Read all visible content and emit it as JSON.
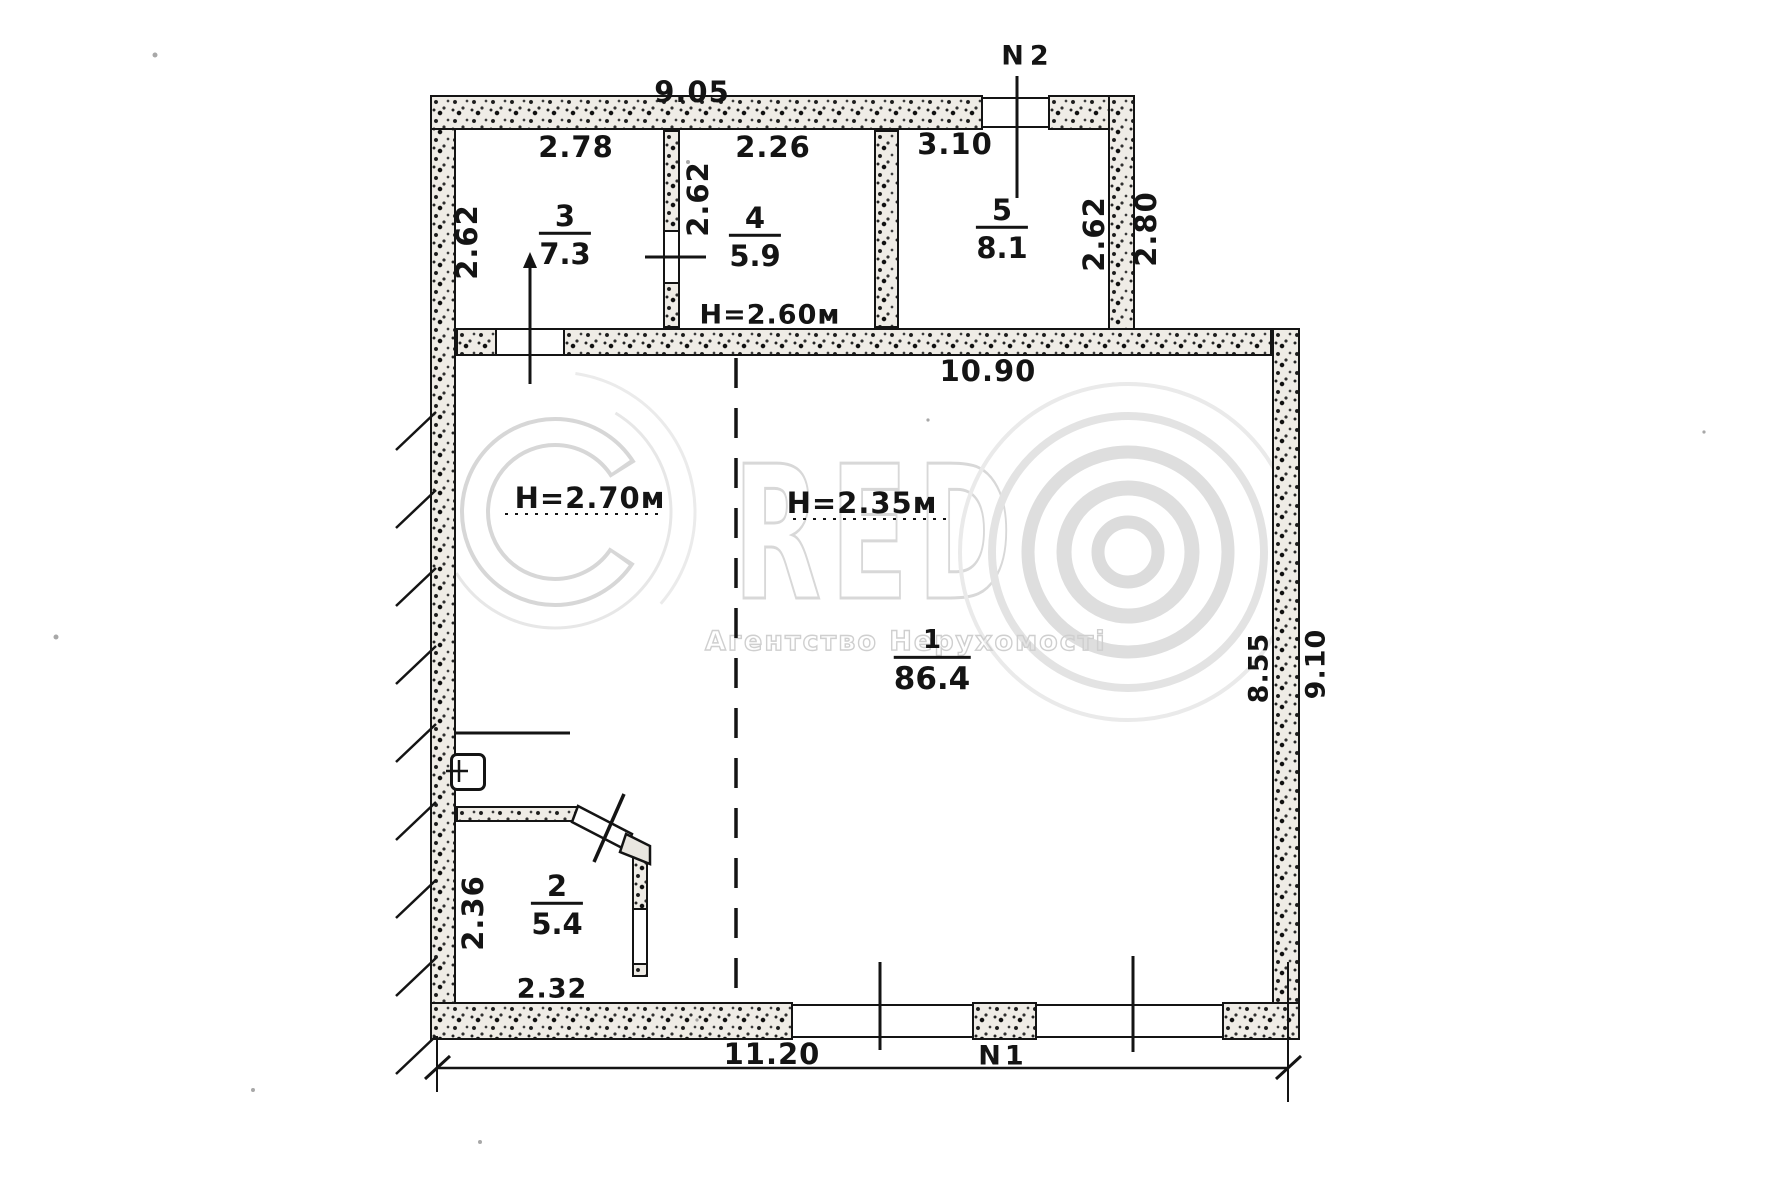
{
  "plan": {
    "entrance_marks": {
      "n1": "N1",
      "n2": "N2"
    },
    "overall_dims": {
      "top_width": "9.05",
      "middle_width": "10.90",
      "bottom_width": "11.20",
      "right_inner_height": "8.55",
      "right_outer_height": "9.10",
      "upper_right_outer": "2.80"
    },
    "heights": {
      "upper_rooms": "H=2.60м",
      "main_left": "H=2.70м",
      "main_right": "H=2.35м"
    },
    "rooms": {
      "r1": {
        "number": "1",
        "area": "86.4"
      },
      "r2": {
        "number": "2",
        "area": "5.4",
        "width": "2.32",
        "depth": "2.36"
      },
      "r3": {
        "number": "3",
        "area": "7.3",
        "width": "2.78",
        "depth": "2.62"
      },
      "r4": {
        "number": "4",
        "area": "5.9",
        "width": "2.26",
        "depth": "2.62"
      },
      "r5": {
        "number": "5",
        "area": "8.1",
        "width": "3.10",
        "depth": "2.62"
      }
    },
    "watermark": {
      "brand": "CREDO",
      "letters": "RED",
      "slogan": "Агентство Нерухомості"
    }
  }
}
